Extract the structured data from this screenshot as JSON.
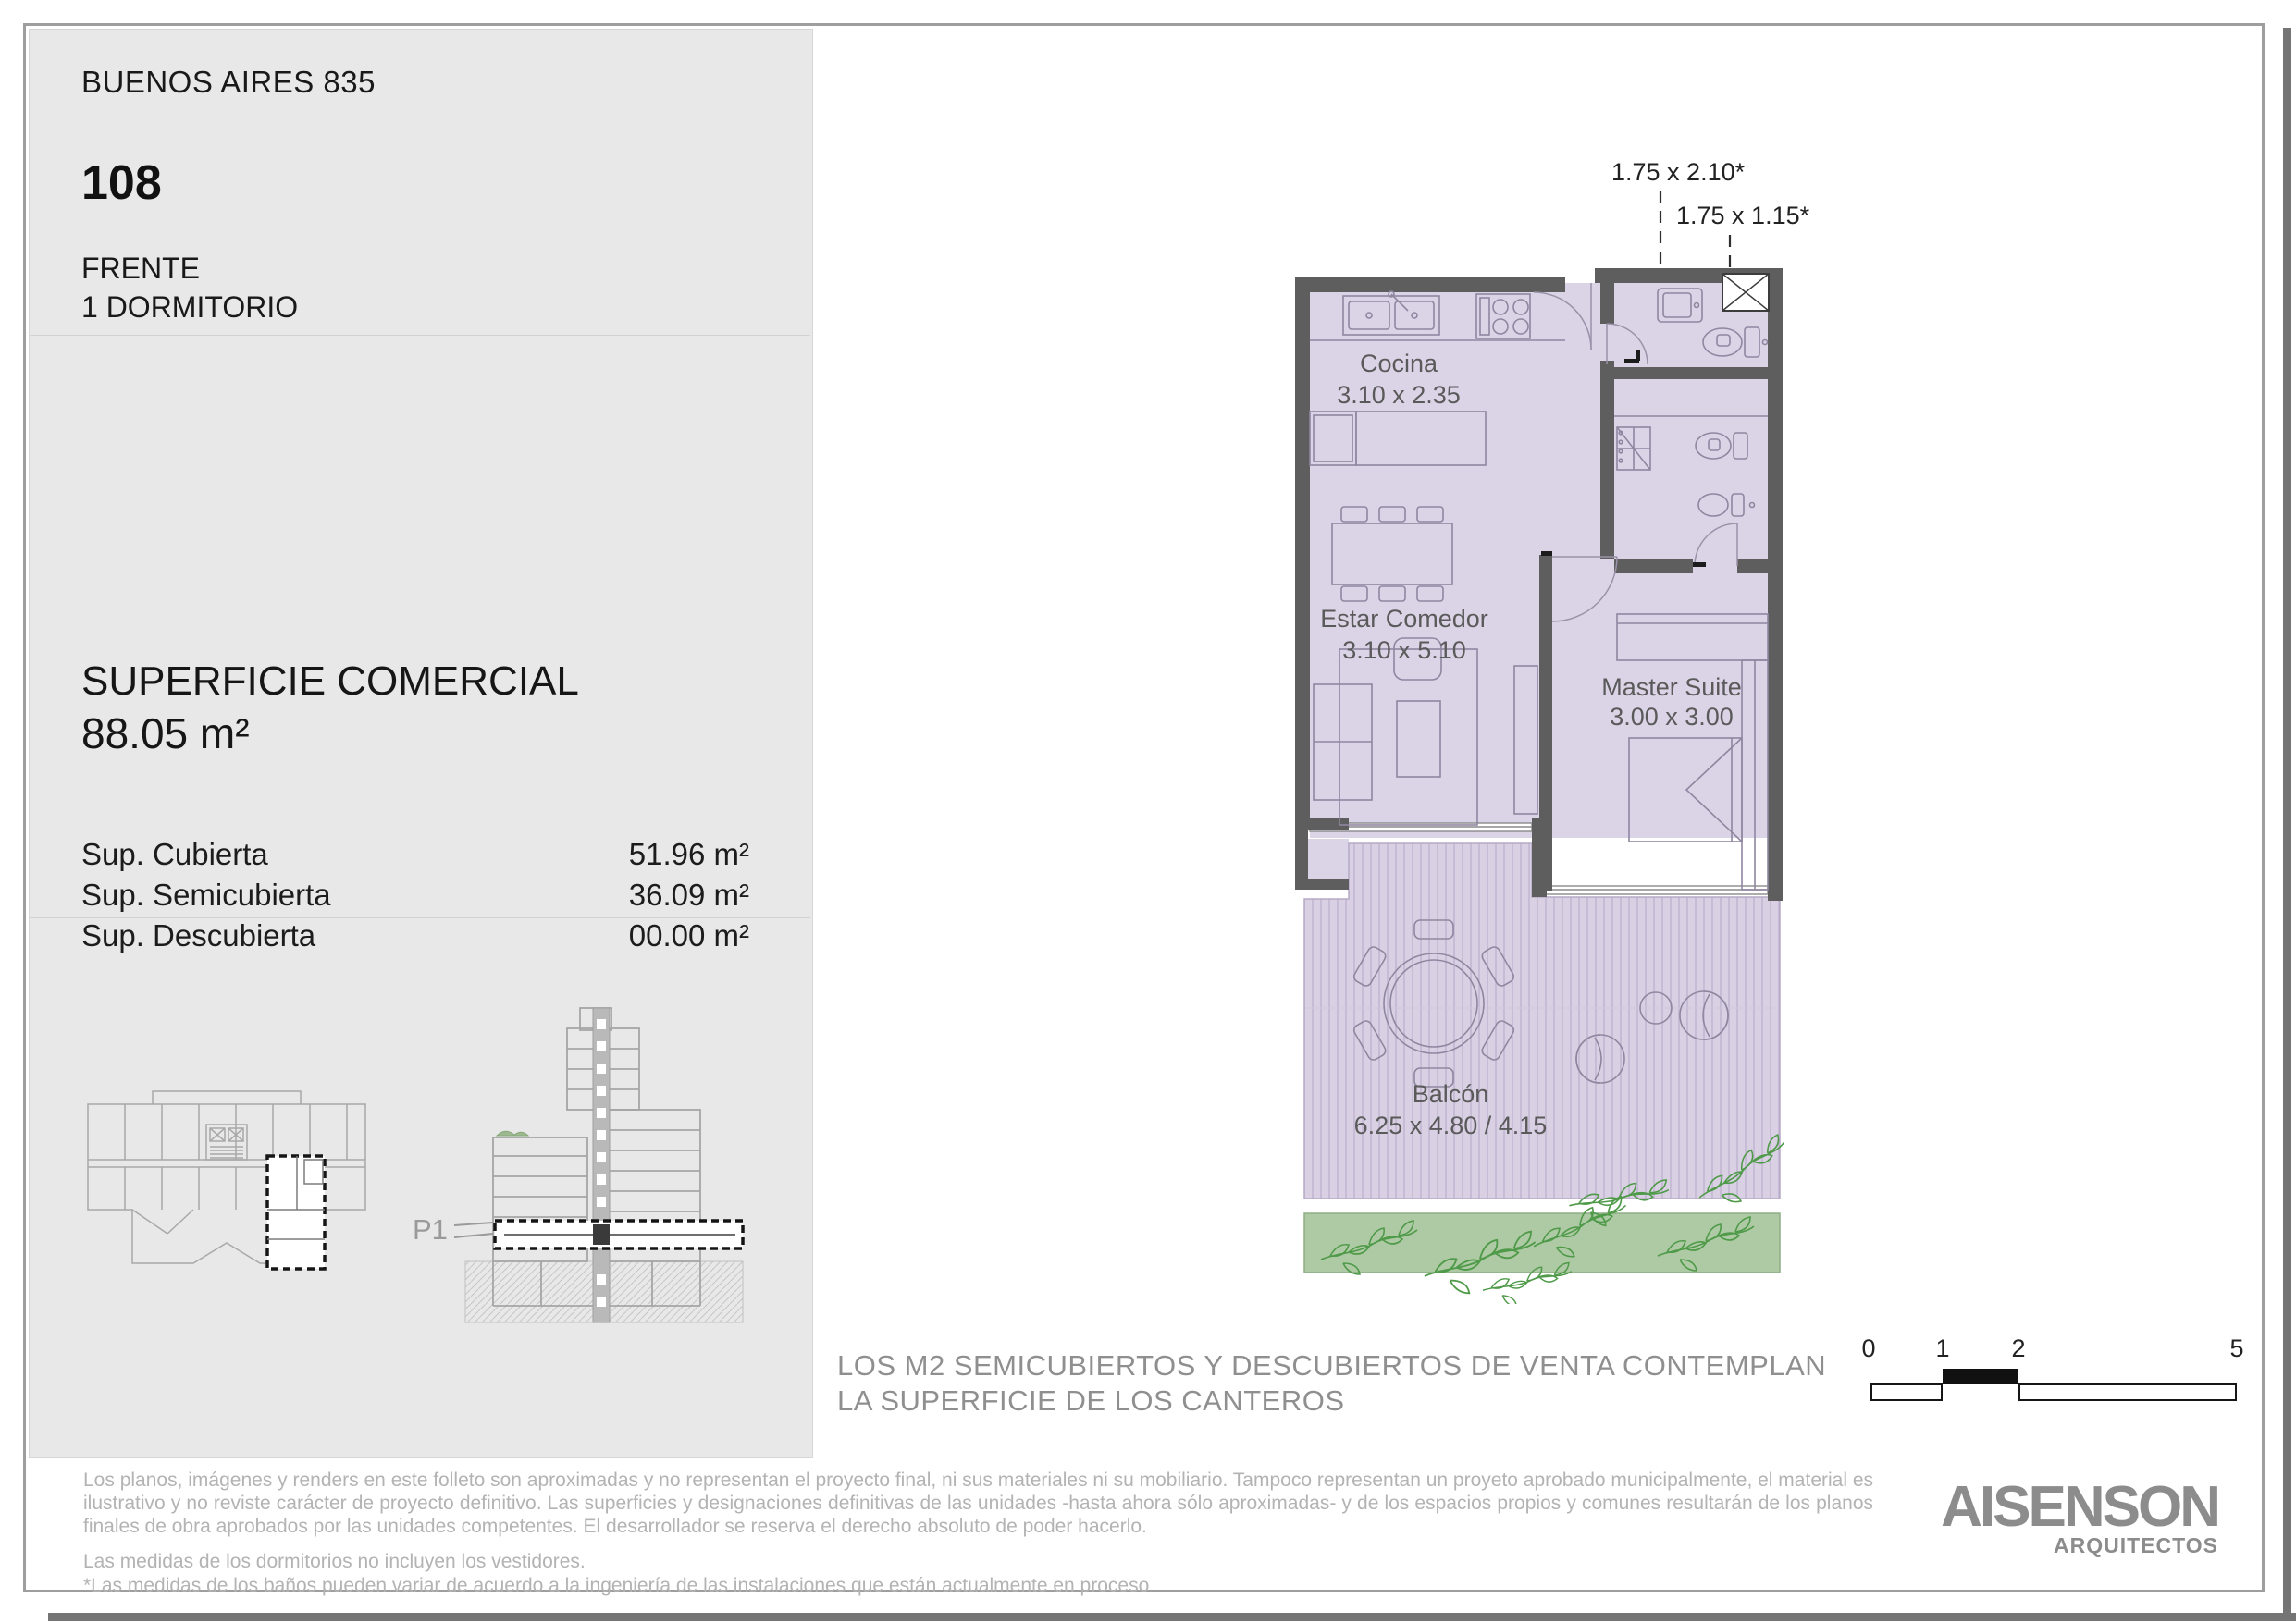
{
  "header": {
    "project": "BUENOS AIRES 835",
    "unit": "108",
    "orientation": "FRENTE",
    "type": "1 DORMITORIO"
  },
  "surface": {
    "title": "SUPERFICIE COMERCIAL",
    "total": "88.05 m²",
    "rows": [
      {
        "label": "Sup. Cubierta",
        "value": "51.96 m²"
      },
      {
        "label": "Sup. Semicubierta",
        "value": "36.09 m²"
      },
      {
        "label": "Sup. Descubierta",
        "value": "00.00 m²"
      }
    ]
  },
  "plan": {
    "dims": [
      {
        "label": "1.75 x 2.10*"
      },
      {
        "label": "1.75 x 1.15*"
      }
    ],
    "rooms": [
      {
        "name": "Cocina",
        "size": "3.10 x 2.35"
      },
      {
        "name": "Estar Comedor",
        "size": "3.10 x 5.10"
      },
      {
        "name": "Master Suite",
        "size": "3.00 x 3.00"
      },
      {
        "name": "Balcón",
        "size": "6.25 x 4.80 / 4.15"
      }
    ]
  },
  "key_plan": {
    "floor_label": "P1"
  },
  "scale_bar": {
    "ticks": [
      "0",
      "1",
      "2",
      "5"
    ]
  },
  "note": {
    "line1": "LOS M2 SEMICUBIERTOS Y DESCUBIERTOS DE VENTA CONTEMPLAN",
    "line2": "LA SUPERFICIE DE LOS CANTEROS"
  },
  "footer": {
    "disclaimer1": "Los planos, imágenes y renders en este folleto son aproximadas y no representan el proyecto final, ni sus materiales ni su mobiliario. Tampoco representan un proyeto aprobado municipalmente, el material es ilustrativo y no reviste carácter de proyecto definitivo. Las superficies y designaciones definitivas de las unidades -hasta ahora sólo aproximadas- y de los espacios propios y comunes resultarán de los planos finales de obra aprobados por las unidades competentes. El desarrollador se reserva el derecho absoluto de poder hacerlo.",
    "disclaimer2": "Las medidas de los dormitorios no incluyen los vestidores.",
    "disclaimer3": "*Las medidas de los baños pueden variar de acuerdo a la ingeniería de las instalaciones que están actualmente en proceso",
    "logo": "AISENSON",
    "logo_sub": "ARQUITECTOS"
  },
  "colors": {
    "room_fill": "#dbd3e6",
    "wall": "#5e5e5e",
    "planter_green": "#aecaa4",
    "leaf_green": "#4f9a49",
    "panel_bg": "#e8e8e8",
    "note_gray": "#8f8f8f",
    "footer_gray": "#b3b3b3"
  }
}
